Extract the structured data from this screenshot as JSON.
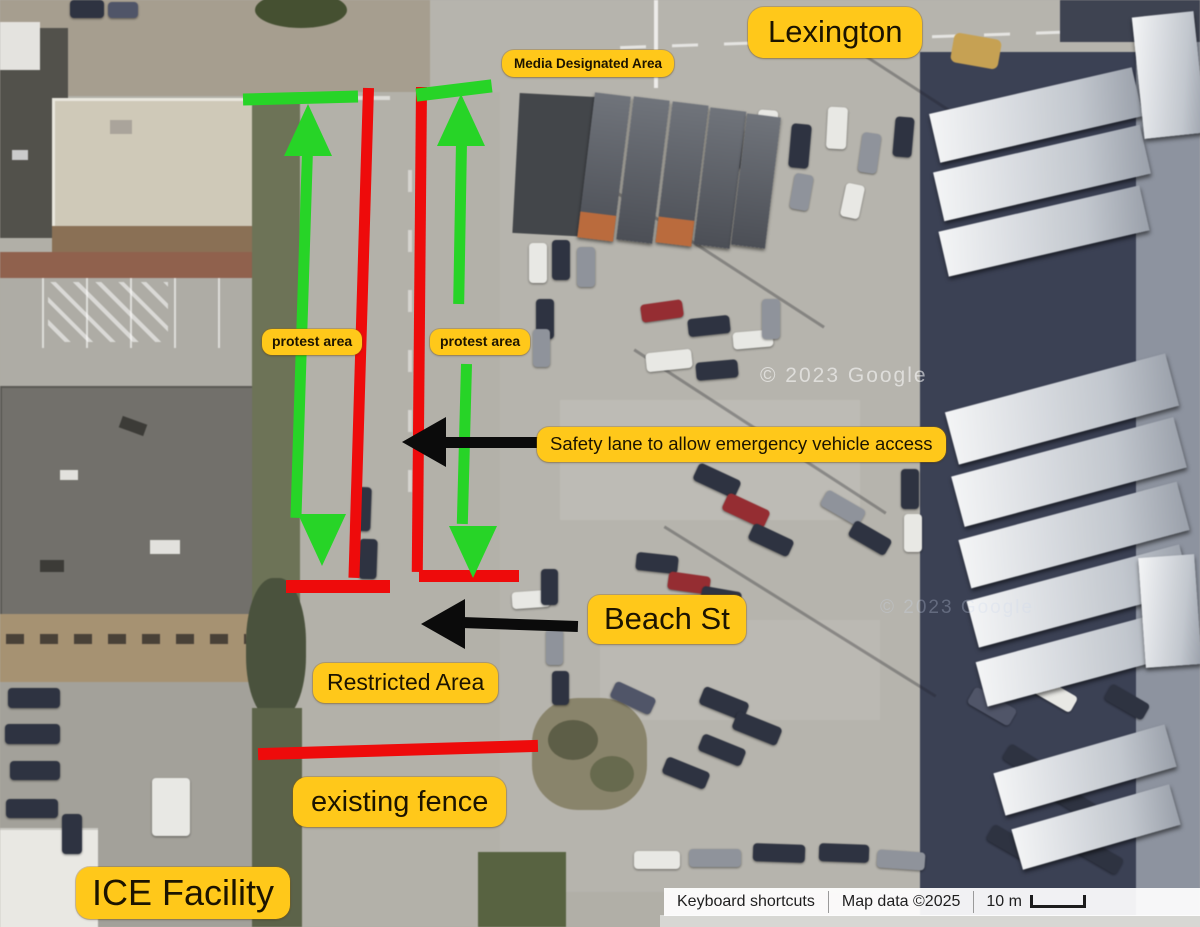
{
  "annotations": {
    "labels": {
      "lexington": "Lexington",
      "media_area": "Media Designated Area",
      "protest_left": "protest area",
      "protest_right": "protest area",
      "safety_lane": "Safety lane to allow emergency vehicle access",
      "beach_st": "Beach St",
      "restricted": "Restricted Area",
      "existing_fence": "existing fence",
      "ice_facility": "ICE Facility"
    },
    "colors": {
      "label_bg": "#ffc81a",
      "label_text": "#1c1400",
      "fence_red": "#ee0b0b",
      "route_green": "#27d427",
      "arrow_black": "#0b0b0b"
    }
  },
  "attribution": {
    "keyboard_shortcuts": "Keyboard shortcuts",
    "map_data": "Map data ©2025",
    "scale_text": "10 m"
  },
  "watermarks": {
    "primary": "© 2023 Google",
    "secondary": "© 2023 Google"
  },
  "scene": {
    "palette": {
      "n": "#2e3342",
      "w": "#e8e8e4",
      "g": "#8f939c",
      "r": "#9c2b30",
      "s": "#50556a"
    },
    "cars": [
      [
        722,
        126,
        20,
        44,
        6,
        "n"
      ],
      [
        757,
        110,
        20,
        42,
        4,
        "w"
      ],
      [
        790,
        124,
        20,
        44,
        5,
        "n"
      ],
      [
        827,
        107,
        20,
        42,
        3,
        "w"
      ],
      [
        860,
        133,
        19,
        40,
        8,
        "g"
      ],
      [
        894,
        117,
        19,
        40,
        5,
        "n"
      ],
      [
        792,
        174,
        19,
        36,
        10,
        "g"
      ],
      [
        843,
        184,
        19,
        34,
        12,
        "w"
      ],
      [
        529,
        243,
        18,
        40,
        0,
        "w"
      ],
      [
        552,
        240,
        18,
        40,
        0,
        "n"
      ],
      [
        577,
        247,
        18,
        40,
        0,
        "g"
      ],
      [
        536,
        299,
        18,
        40,
        0,
        "n"
      ],
      [
        533,
        329,
        17,
        38,
        0,
        "g"
      ],
      [
        641,
        302,
        42,
        18,
        -8,
        "r"
      ],
      [
        688,
        317,
        42,
        18,
        -6,
        "n"
      ],
      [
        733,
        331,
        40,
        17,
        -5,
        "w"
      ],
      [
        646,
        351,
        46,
        19,
        -6,
        "w"
      ],
      [
        696,
        361,
        42,
        18,
        -5,
        "n"
      ],
      [
        762,
        299,
        18,
        40,
        0,
        "g"
      ],
      [
        694,
        471,
        46,
        19,
        25,
        "n"
      ],
      [
        723,
        501,
        46,
        19,
        25,
        "r"
      ],
      [
        749,
        531,
        44,
        18,
        25,
        "n"
      ],
      [
        821,
        499,
        44,
        18,
        30,
        "g"
      ],
      [
        849,
        529,
        42,
        18,
        30,
        "n"
      ],
      [
        352,
        487,
        19,
        44,
        2,
        "n"
      ],
      [
        359,
        539,
        18,
        40,
        2,
        "n"
      ],
      [
        512,
        591,
        38,
        17,
        -4,
        "w"
      ],
      [
        541,
        569,
        17,
        36,
        0,
        "n"
      ],
      [
        546,
        629,
        17,
        36,
        0,
        "g"
      ],
      [
        552,
        671,
        17,
        34,
        0,
        "n"
      ],
      [
        636,
        554,
        42,
        18,
        6,
        "n"
      ],
      [
        668,
        574,
        42,
        18,
        8,
        "r"
      ],
      [
        701,
        589,
        40,
        17,
        10,
        "n"
      ],
      [
        700,
        694,
        48,
        19,
        22,
        "n"
      ],
      [
        733,
        719,
        48,
        19,
        22,
        "n"
      ],
      [
        699,
        741,
        46,
        18,
        22,
        "n"
      ],
      [
        663,
        764,
        46,
        18,
        22,
        "n"
      ],
      [
        611,
        689,
        44,
        18,
        25,
        "s"
      ],
      [
        634,
        851,
        46,
        18,
        0,
        "w"
      ],
      [
        689,
        849,
        52,
        18,
        0,
        "g"
      ],
      [
        753,
        844,
        52,
        18,
        2,
        "n"
      ],
      [
        819,
        844,
        50,
        18,
        2,
        "n"
      ],
      [
        877,
        851,
        48,
        18,
        4,
        "g"
      ],
      [
        968,
        697,
        48,
        19,
        30,
        "s"
      ],
      [
        1031,
        685,
        46,
        18,
        30,
        "w"
      ],
      [
        1003,
        754,
        46,
        18,
        32,
        "n"
      ],
      [
        1053,
        794,
        46,
        18,
        32,
        "n"
      ],
      [
        987,
        834,
        46,
        18,
        30,
        "n"
      ],
      [
        1077,
        847,
        46,
        18,
        30,
        "n"
      ],
      [
        1105,
        693,
        44,
        18,
        30,
        "n"
      ],
      [
        901,
        469,
        18,
        40,
        0,
        "n"
      ],
      [
        904,
        514,
        18,
        38,
        0,
        "w"
      ],
      [
        8,
        688,
        52,
        20,
        0,
        "n"
      ],
      [
        5,
        724,
        55,
        20,
        0,
        "n"
      ],
      [
        10,
        761,
        50,
        19,
        0,
        "n"
      ],
      [
        6,
        799,
        52,
        19,
        0,
        "n"
      ],
      [
        152,
        778,
        38,
        58,
        0,
        "w"
      ],
      [
        62,
        814,
        20,
        40,
        0,
        "n"
      ],
      [
        70,
        0,
        34,
        18,
        0,
        "n"
      ],
      [
        108,
        2,
        30,
        16,
        0,
        "s"
      ]
    ],
    "trailers": [
      [
        586,
        94,
        36,
        146,
        7,
        1
      ],
      [
        625,
        98,
        36,
        144,
        7,
        0
      ],
      [
        664,
        103,
        36,
        142,
        7,
        1
      ],
      [
        702,
        109,
        36,
        138,
        7,
        0
      ],
      [
        739,
        115,
        34,
        132,
        7,
        0
      ]
    ],
    "panels": [
      [
        932,
        90,
        208,
        50,
        -13
      ],
      [
        936,
        148,
        212,
        50,
        -13
      ],
      [
        941,
        208,
        206,
        46,
        -13
      ],
      [
        948,
        382,
        228,
        54,
        -15
      ],
      [
        954,
        446,
        230,
        52,
        -15
      ],
      [
        961,
        510,
        226,
        50,
        -15
      ],
      [
        969,
        572,
        220,
        48,
        -15
      ],
      [
        978,
        634,
        212,
        46,
        -15
      ],
      [
        996,
        748,
        178,
        44,
        -16
      ],
      [
        1014,
        806,
        164,
        42,
        -16
      ],
      [
        1138,
        14,
        62,
        122,
        -6
      ],
      [
        1142,
        556,
        56,
        110,
        -4
      ]
    ]
  }
}
